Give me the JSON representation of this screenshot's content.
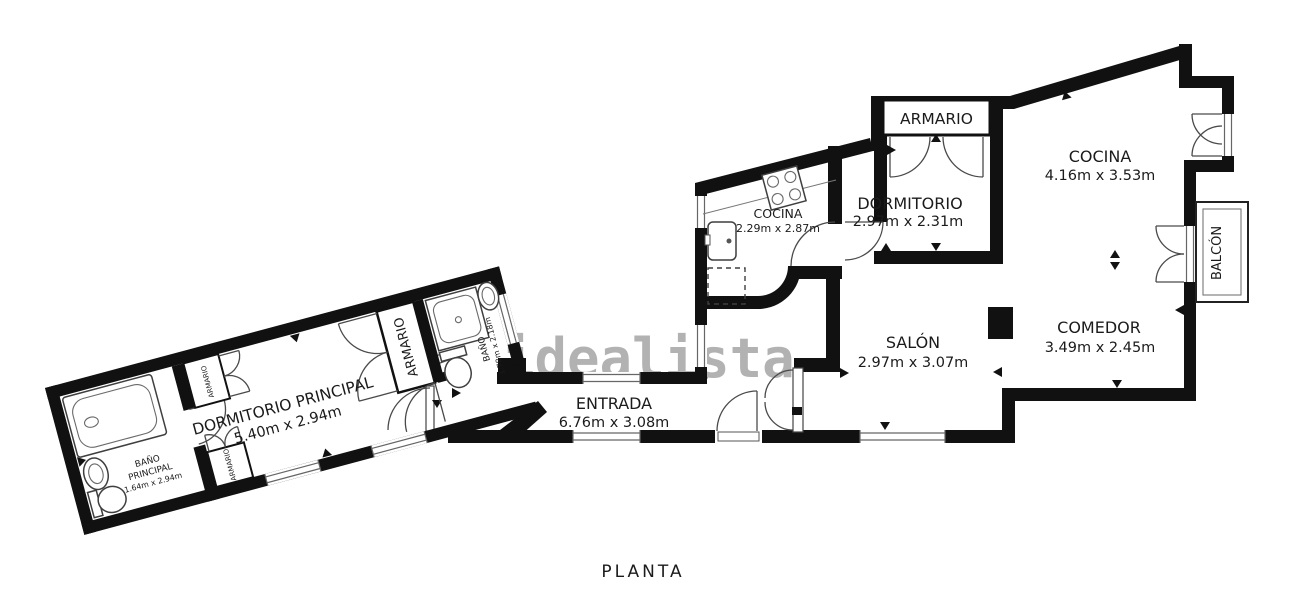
{
  "title": "PLANTA",
  "watermark": "idealista",
  "colors": {
    "wall": "#111111",
    "line": "#3a3a3a",
    "window_line": "#666666",
    "watermark": "#b2b2b2",
    "background": "#ffffff",
    "text": "#1b1b1b"
  },
  "rooms": {
    "dormitorio_principal": {
      "name": "DORMITORIO PRINCIPAL",
      "dims": "5.40m x 2.94m"
    },
    "bano_principal": {
      "line1": "BAÑO",
      "line2": "PRINCIPAL",
      "dims": "1.64m x 2.94m"
    },
    "armario_top": {
      "name": "ARMARIO"
    },
    "armario_bottom": {
      "name": "ARMARIO"
    },
    "armario_grande": {
      "name": "ARMARIO"
    },
    "bano": {
      "name": "BAÑO",
      "dims": "1.78m x 2.18m"
    },
    "entrada": {
      "name": "ENTRADA",
      "dims": "6.76m x 3.08m"
    },
    "cocina_pequena": {
      "name": "COCINA",
      "dims": "2.29m x 2.87m"
    },
    "dormitorio": {
      "name": "DORMITORIO",
      "dims": "2.97m x 2.31m"
    },
    "armario_dormitorio": {
      "name": "ARMARIO"
    },
    "cocina": {
      "name": "COCINA",
      "dims": "4.16m x 3.53m"
    },
    "salon": {
      "name": "SALÓN",
      "dims": "2.97m x 3.07m"
    },
    "comedor": {
      "name": "COMEDOR",
      "dims": "3.49m x 2.45m"
    },
    "balcon": {
      "name": "BALCÓN"
    }
  }
}
